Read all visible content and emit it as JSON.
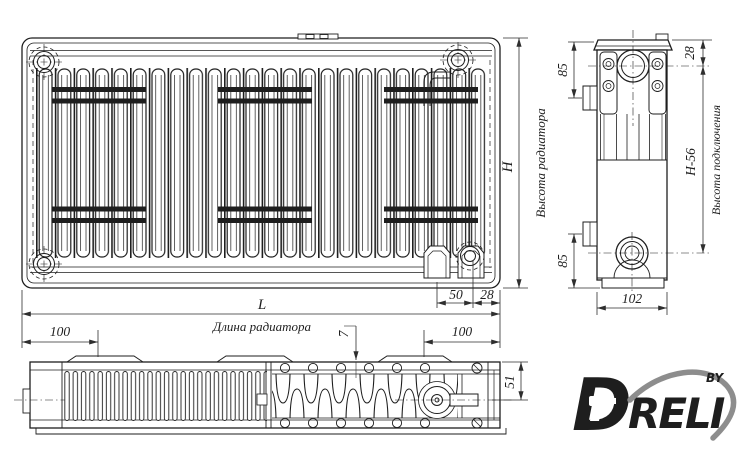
{
  "views": {
    "front": {
      "dim_height_label": "H",
      "caption_height": "Высота радиатора",
      "dim_length_label": "L",
      "caption_length": "Длина радиатора",
      "dim_valve_offset": "50",
      "dim_edge_offset": "28",
      "dim_bracket_left": "100",
      "dim_bracket_right": "100"
    },
    "side": {
      "dim_top_port": "28",
      "dim_bracket_top": "85",
      "dim_bracket_bottom": "85",
      "dim_connection_height": "H-56",
      "caption_connection": "Высота подключения",
      "dim_depth": "102"
    },
    "bottom": {
      "dim_grille_thickness": "7",
      "dim_valve_axis": "51"
    }
  },
  "logo": {
    "letter_d": "D",
    "brand_rest": "RELI",
    "suffix": "BY",
    "orange": "#ed7d23",
    "gray": "#8d8d8d"
  },
  "colors": {
    "line": "#1e1e1e",
    "dim": "#2e2e2e",
    "background": "#ffffff"
  }
}
